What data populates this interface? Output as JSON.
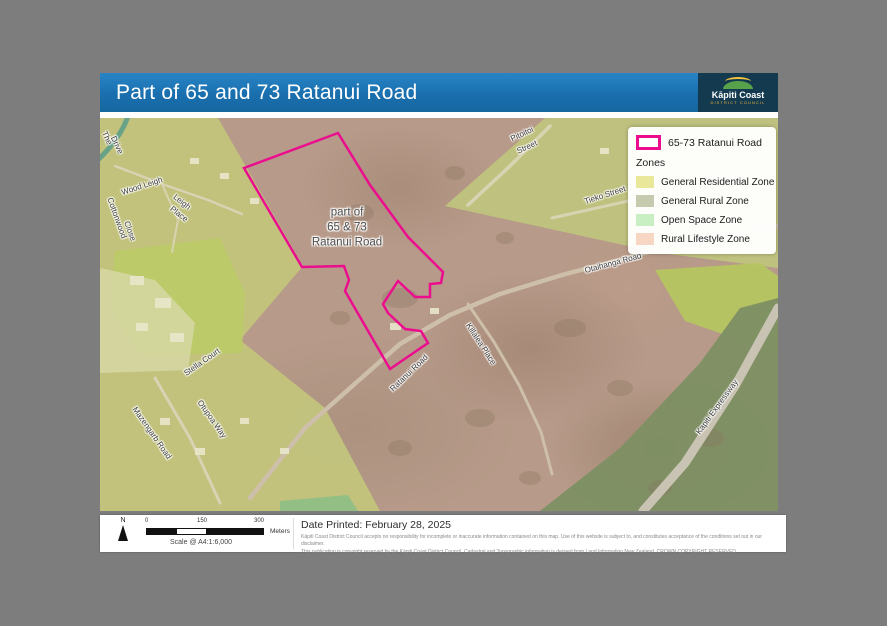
{
  "header": {
    "title": "Part of 65 and 73 Ratanui Road",
    "logo": {
      "name": "Kāpiti Coast",
      "sub": "DISTRICT COUNCIL"
    }
  },
  "map": {
    "parcel_label": {
      "line1": "part of",
      "line2": "65 & 73",
      "line3": "Ratanui Road"
    },
    "labels": [
      {
        "t": "The",
        "x": 7,
        "y": 20,
        "r": 65
      },
      {
        "t": "Drive",
        "x": 17,
        "y": 27,
        "r": 65
      },
      {
        "t": "Wood Leigh",
        "x": 42,
        "y": 68,
        "r": -18
      },
      {
        "t": "Leigh",
        "x": 82,
        "y": 84,
        "r": 38
      },
      {
        "t": "Place",
        "x": 79,
        "y": 96,
        "r": 38
      },
      {
        "t": "Cottonwood",
        "x": 17,
        "y": 100,
        "r": 70
      },
      {
        "t": "Close",
        "x": 30,
        "y": 113,
        "r": 70
      },
      {
        "t": "Stella Court",
        "x": 102,
        "y": 244,
        "r": -35
      },
      {
        "t": "Mazengarb Road",
        "x": 52,
        "y": 315,
        "r": 55
      },
      {
        "t": "Otupoa Way",
        "x": 112,
        "y": 301,
        "r": 55
      },
      {
        "t": "Ratanui Road",
        "x": 309,
        "y": 255,
        "r": -44
      },
      {
        "t": "Killalea Place",
        "x": 381,
        "y": 226,
        "r": 57
      },
      {
        "t": "Pitoitoi",
        "x": 422,
        "y": 16,
        "r": -25
      },
      {
        "t": "Street",
        "x": 427,
        "y": 29,
        "r": -25
      },
      {
        "t": "Tieko Street",
        "x": 505,
        "y": 77,
        "r": -18
      },
      {
        "t": "Otaihanga Road",
        "x": 513,
        "y": 145,
        "r": -15
      },
      {
        "t": "Kapiti Expressway",
        "x": 617,
        "y": 289,
        "r": -54
      }
    ]
  },
  "legend": {
    "parcel": {
      "label": "65-73 Ratanui Road",
      "color": "#ec0d8e"
    },
    "zones_title": "Zones",
    "zones": [
      {
        "label": "General Residential Zone",
        "color": "#e9e799"
      },
      {
        "label": "General Rural Zone",
        "color": "#c6cbb0"
      },
      {
        "label": "Open Space Zone",
        "color": "#c8eec4"
      },
      {
        "label": "Rural Lifestyle Zone",
        "color": "#f7d7c4"
      }
    ]
  },
  "footer": {
    "north_label": "N",
    "scale": {
      "t0": "0",
      "t150": "150",
      "t300": "300",
      "unit": "Meters",
      "caption": "Scale @ A4:1:6,000"
    },
    "date_printed": "Date Printed: February 28, 2025",
    "disclaimer1": "Kāpiti Coast District Council accepts no responsibility for incomplete or inaccurate information contained on this map. Use of this website is subject to, and constitutes acceptance of the conditions set out in our disclaimer.",
    "disclaimer2": "This publication is copyright reserved by the Kāpiti Coast District Council. Cadastral and Topographic information is derived from Land Information New Zealand. CROWN COPYRIGHT RESERVED"
  }
}
